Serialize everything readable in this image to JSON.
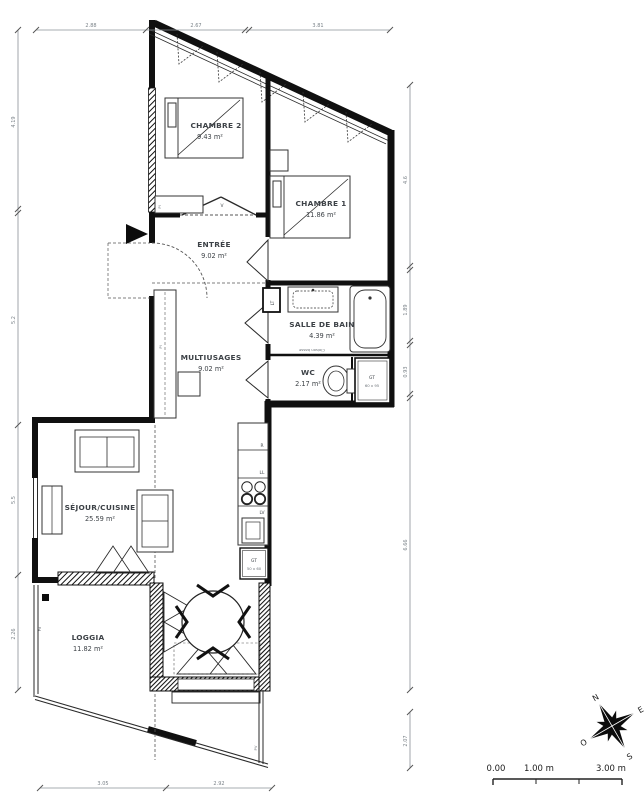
{
  "rooms": {
    "chambre2": {
      "name": "CHAMBRE 2",
      "area": "9.43 m²"
    },
    "chambre1": {
      "name": "CHAMBRE 1",
      "area": "11.86 m²"
    },
    "entree": {
      "name": "ENTRÉE",
      "area": "9.02 m²"
    },
    "salle_de_bain": {
      "name": "SALLE DE BAIN",
      "area": "4.39 m²"
    },
    "multiusages": {
      "name": "MULTIUSAGES",
      "area": "9.02 m²"
    },
    "wc": {
      "name": "WC",
      "area": "2.17 m²"
    },
    "sejour": {
      "name": "SÉJOUR/CUISINE",
      "area": "25.59 m²"
    },
    "loggia": {
      "name": "LOGGIA",
      "area": "11.82 m²"
    }
  },
  "labels": {
    "gt_wc_1": "GT",
    "gt_wc_2": "60 x 95",
    "gt_kitchen_1": "GT",
    "gt_kitchen_2": "50 x 60",
    "fridge": "R",
    "washer": "LL",
    "dishwasher": "LV",
    "duct": "LT",
    "door_v": "V",
    "closet_1": "Pl",
    "closet_2": "Pl",
    "door_pd": "Pd",
    "window_pv": "PV",
    "partition_note": "Cloison basse"
  },
  "dimensions": {
    "top": [
      "2.88",
      "2.67",
      "3.81"
    ],
    "left": [
      "4.19",
      "5.2",
      "5.5",
      "2.26"
    ],
    "right": [
      "4.6",
      "1.89",
      "0.93",
      "6.66",
      "2.07"
    ],
    "bottom": [
      "3.05",
      "2.92"
    ]
  },
  "scale_bar": {
    "start": "0.00",
    "mid": "1.00 m",
    "end": "3.00 m"
  },
  "compass": {
    "n": "N",
    "e": "E",
    "s": "S",
    "o": "O"
  },
  "colors": {
    "wall": "#101010",
    "dim_text": "#7a8288",
    "background": "#ffffff"
  }
}
